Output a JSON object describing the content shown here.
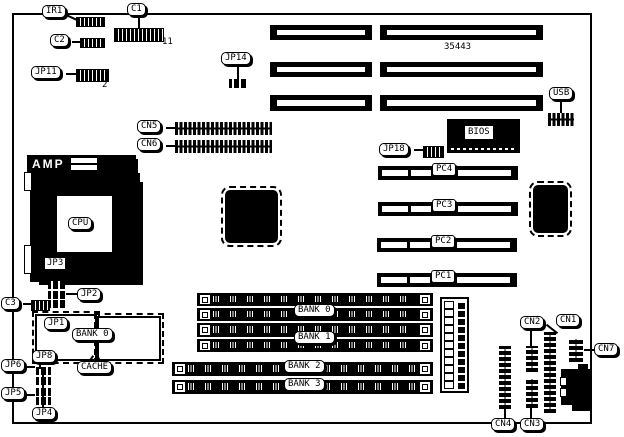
{
  "diagram": {
    "title_part_number": "35443",
    "power_connector_label": "AMP",
    "cpu_label": "CPU",
    "bios_label": "BIOS",
    "usb_label": "USB",
    "cache_label": "CACHE",
    "cache_bank_label": "BANK 0",
    "c1_pin_count": "11",
    "jp11_pin_count": "2",
    "pci_slots": [
      "PC4",
      "PC3",
      "PC2",
      "PC1"
    ],
    "memory_banks": [
      "BANK 0",
      "BANK 1",
      "BANK 2",
      "BANK 3"
    ],
    "connectors": {
      "ir1": "IR1",
      "c1": "C1",
      "c2": "C2",
      "c3": "C3",
      "cn1": "CN1",
      "cn2": "CN2",
      "cn3": "CN3",
      "cn4": "CN4",
      "cn5": "CN5",
      "cn6": "CN6",
      "cn7": "CN7"
    },
    "jumpers": {
      "jp1": "JP1",
      "jp2": "JP2",
      "jp3": "JP3",
      "jp4": "JP4",
      "jp5": "JP5",
      "jp6": "JP6",
      "jp8": "JP8",
      "jp11": "JP11",
      "jp14": "JP14",
      "jp18": "JP18"
    }
  }
}
